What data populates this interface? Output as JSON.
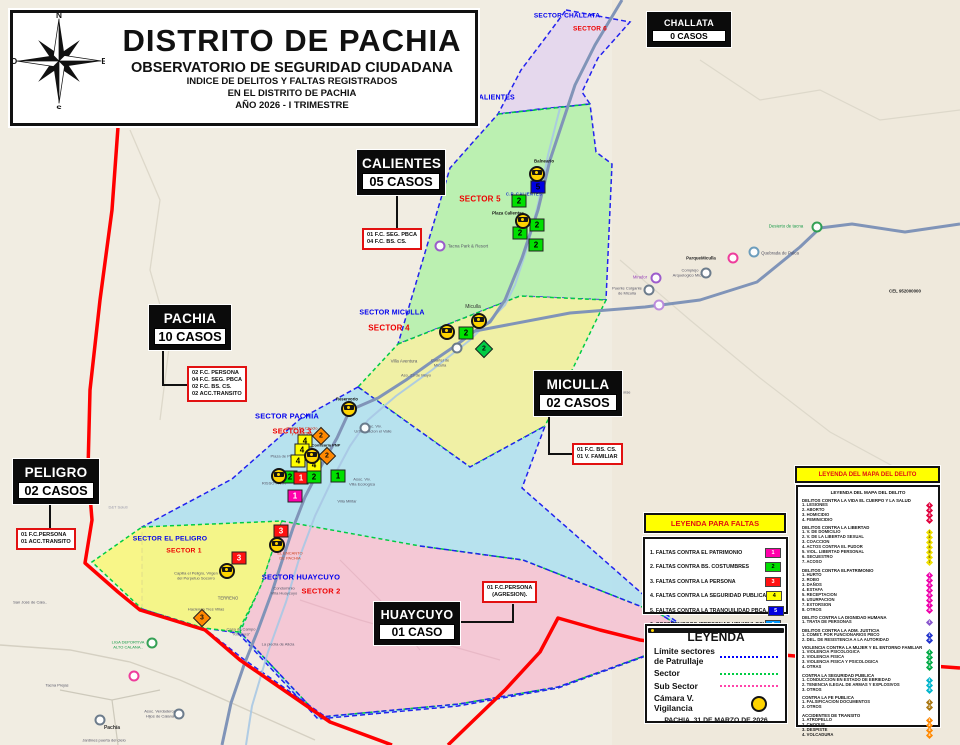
{
  "header": {
    "title": "DISTRITO DE PACHIA",
    "subtitle": "OBSERVATORIO DE SEGURIDAD CIUDADANA",
    "line1": "INDICE DE DELITOS Y FALTAS REGISTRADOS",
    "line2": "EN EL DISTRITO DE PACHIA",
    "line3": "AÑO 2026 - I TRIMESTRE",
    "compass": {
      "n": "N",
      "s": "S",
      "e": "E",
      "o": "O"
    }
  },
  "stat_boxes": [
    {
      "id": "challata",
      "name": "CHALLATA",
      "cases": "0 CASOS",
      "x": 647,
      "y": 12,
      "w": 74,
      "fs": 9
    },
    {
      "id": "calientes",
      "name": "CALIENTES",
      "cases": "05 CASOS",
      "x": 357,
      "y": 150,
      "w": 78,
      "fs": 13.5
    },
    {
      "id": "pachia",
      "name": "PACHIA",
      "cases": "10 CASOS",
      "x": 149,
      "y": 305,
      "w": 72,
      "fs": 13.5
    },
    {
      "id": "miculla",
      "name": "MICULLA",
      "cases": "02 CASOS",
      "x": 534,
      "y": 371,
      "w": 78,
      "fs": 13.5
    },
    {
      "id": "peligro",
      "name": "PELIGRO",
      "cases": "02 CASOS",
      "x": 13,
      "y": 459,
      "w": 76,
      "fs": 13.5
    },
    {
      "id": "huaycuyo",
      "name": "HUAYCUYO",
      "cases": "01 CASO",
      "x": 374,
      "y": 602,
      "w": 76,
      "fs": 12.5
    }
  ],
  "detail_boxes": [
    {
      "id": "calientes-detail",
      "x": 362,
      "y": 228,
      "center": false,
      "lines": [
        "01 F.C. SEG. PBCA",
        "04 F.C. BS. CS."
      ]
    },
    {
      "id": "pachia-detail",
      "x": 187,
      "y": 366,
      "center": false,
      "lines": [
        "02 F.C. PERSONA",
        "04 F.C. SEG. PBCA",
        "02 F.C. BS. CS.",
        "02 ACC.TRANSITO"
      ]
    },
    {
      "id": "miculla-detail",
      "x": 572,
      "y": 443,
      "center": false,
      "lines": [
        "01 F.C. BS. CS.",
        "01 V. FAMILIAR"
      ]
    },
    {
      "id": "peligro-detail",
      "x": 16,
      "y": 528,
      "center": false,
      "lines": [
        "01 F.C.PERSONA",
        "01 ACC.TRANSITO"
      ]
    },
    {
      "id": "huaycuyo-detail",
      "x": 482,
      "y": 581,
      "center": true,
      "lines": [
        "01 F.C.PERSONA",
        "(AGRESION)."
      ]
    }
  ],
  "sector_labels": [
    {
      "x": 567,
      "y": 16,
      "t": "SECTOR CHALLATA",
      "c": "#0000ee",
      "s": 6.5
    },
    {
      "x": 590,
      "y": 29,
      "t": "SECTOR 6",
      "c": "#ee0000",
      "s": 6.5
    },
    {
      "x": 478,
      "y": 98,
      "t": "SECTOR CALIENTES",
      "c": "#0000ee",
      "s": 7
    },
    {
      "x": 480,
      "y": 199,
      "t": "SECTOR 5",
      "c": "#ee0000",
      "s": 8
    },
    {
      "x": 524,
      "y": 194,
      "t": "C.P. CALIENTES",
      "c": "#2233cc",
      "s": 4.3
    },
    {
      "x": 392,
      "y": 313,
      "t": "SECTOR MICULLA",
      "c": "#0000ee",
      "s": 7
    },
    {
      "x": 389,
      "y": 328,
      "t": "SECTOR 4",
      "c": "#ee0000",
      "s": 8
    },
    {
      "x": 287,
      "y": 416,
      "t": "SECTOR PACHIA",
      "c": "#0000ee",
      "s": 7.5
    },
    {
      "x": 292,
      "y": 431,
      "t": "SECTOR 3",
      "c": "#ee0000",
      "s": 7.5
    },
    {
      "x": 170,
      "y": 539,
      "t": "SECTOR EL PELIGRO",
      "c": "#0000ee",
      "s": 6.8
    },
    {
      "x": 184,
      "y": 551,
      "t": "SECTOR 1",
      "c": "#ee0000",
      "s": 6.8
    },
    {
      "x": 301,
      "y": 577,
      "t": "SECTOR HUAYCUYO",
      "c": "#0000ee",
      "s": 7.5
    },
    {
      "x": 321,
      "y": 591,
      "t": "SECTOR 2",
      "c": "#ee0000",
      "s": 7.5
    }
  ],
  "map_labels": [
    {
      "x": 544,
      "y": 161,
      "t": "Balneario",
      "c": "#111",
      "s": 4.4,
      "b": 1
    },
    {
      "x": 508,
      "y": 213,
      "t": "Plaza Calientes",
      "c": "#111",
      "s": 4.4,
      "b": 1
    },
    {
      "x": 468,
      "y": 246,
      "t": "Tacna Park & Resort",
      "c": "#555566",
      "s": 4.4,
      "b": 0
    },
    {
      "x": 473,
      "y": 308,
      "t": "Miculla",
      "c": "#333333",
      "s": 5,
      "b": 0
    },
    {
      "x": 404,
      "y": 361,
      "t": "Villa Aventura",
      "c": "#556",
      "s": 4.4,
      "b": 0
    },
    {
      "x": 440,
      "y": 363,
      "t": "Cuartel de\nMiculla",
      "c": "#556",
      "s": 4,
      "b": 0
    },
    {
      "x": 416,
      "y": 376,
      "t": "Aso. 23 de Mayo",
      "c": "#556",
      "s": 4,
      "b": 0
    },
    {
      "x": 347,
      "y": 400,
      "t": "Reservorio",
      "c": "#111",
      "s": 4.2,
      "b": 1
    },
    {
      "x": 302,
      "y": 431,
      "t": "Pastel De Choclo\ny HUMITAS",
      "c": "#cc2200",
      "s": 4,
      "b": 0
    },
    {
      "x": 326,
      "y": 446,
      "t": "Comisaria PNP",
      "c": "#111",
      "s": 4,
      "b": 1
    },
    {
      "x": 373,
      "y": 429,
      "t": "Asoc. Viv.\nUrbanizacion el Valle",
      "c": "#556",
      "s": 4,
      "b": 0
    },
    {
      "x": 285,
      "y": 457,
      "t": "Plaza de Pachia",
      "c": "#556",
      "s": 4,
      "b": 0
    },
    {
      "x": 274,
      "y": 484,
      "t": "RISSO PARK",
      "c": "#556",
      "s": 4,
      "b": 0
    },
    {
      "x": 362,
      "y": 482,
      "t": "Asoc. Viv.\nVilla Ecologica",
      "c": "#556",
      "s": 4,
      "b": 0
    },
    {
      "x": 347,
      "y": 502,
      "t": "Villa Militar",
      "c": "#556",
      "s": 4,
      "b": 0
    },
    {
      "x": 290,
      "y": 556,
      "t": "EL ENCANTO\nDE PACHIA",
      "c": "#cc4422",
      "s": 4,
      "b": 0
    },
    {
      "x": 196,
      "y": 576,
      "t": "Capilla el Peligro, Virgen\ndel Perpetuo Socorro",
      "c": "#556",
      "s": 4,
      "b": 0
    },
    {
      "x": 228,
      "y": 599,
      "t": "TERRENO",
      "c": "#556",
      "s": 4.2,
      "b": 0
    },
    {
      "x": 206,
      "y": 610,
      "t": "Hacienda Tres Villas",
      "c": "#556",
      "s": 4,
      "b": 0
    },
    {
      "x": 284,
      "y": 591,
      "t": "Condominio\nVilla Huaycuyo",
      "c": "#556",
      "s": 4,
      "b": 0
    },
    {
      "x": 241,
      "y": 632,
      "t": "Casa de Campo\n\"Kiliseera\"",
      "c": "#556",
      "s": 4,
      "b": 0
    },
    {
      "x": 278,
      "y": 645,
      "t": "La piedra de Alicia",
      "c": "#556",
      "s": 4,
      "b": 0
    },
    {
      "x": 128,
      "y": 645,
      "t": "LIGA DEPORTIVA\nALTO CALANA..",
      "c": "#119944",
      "s": 4,
      "b": 0
    },
    {
      "x": 118,
      "y": 508,
      "t": "D&T Soluti",
      "c": "#99a",
      "s": 4,
      "b": 0
    },
    {
      "x": 30,
      "y": 603,
      "t": "San José de Cala..",
      "c": "#556",
      "s": 4,
      "b": 0
    },
    {
      "x": 57,
      "y": 686,
      "t": "Tacna Prejas",
      "c": "#556",
      "s": 4,
      "b": 0
    },
    {
      "x": 160,
      "y": 714,
      "t": "Asoc. Verdaderos\nHijos de Calana",
      "c": "#556",
      "s": 4,
      "b": 0
    },
    {
      "x": 112,
      "y": 729,
      "t": "Pachía",
      "c": "#333",
      "s": 5,
      "b": 1
    },
    {
      "x": 104,
      "y": 741,
      "t": "Jardines puerta del cielo",
      "c": "#556",
      "s": 4,
      "b": 0
    },
    {
      "x": 786,
      "y": 226,
      "t": "Desierto de tacna",
      "c": "#119944",
      "s": 4.4,
      "b": 0
    },
    {
      "x": 780,
      "y": 253,
      "t": "Quebrada de Palca",
      "c": "#556",
      "s": 4.4,
      "b": 0
    },
    {
      "x": 701,
      "y": 258,
      "t": "ParqueMiculla",
      "c": "#222",
      "s": 4.4,
      "b": 1
    },
    {
      "x": 690,
      "y": 273,
      "t": "Complejo\nArquelogico Miculla",
      "c": "#556",
      "s": 4,
      "b": 0
    },
    {
      "x": 640,
      "y": 278,
      "t": "Mirador",
      "c": "#9944bb",
      "s": 4.2,
      "b": 0
    },
    {
      "x": 627,
      "y": 291,
      "t": "Puente Colgante\nde Miculla",
      "c": "#556",
      "s": 4,
      "b": 0
    },
    {
      "x": 905,
      "y": 291,
      "t": "CEL 952000000",
      "c": "#222",
      "s": 4.4,
      "b": 1
    },
    {
      "x": 612,
      "y": 393,
      "t": "Parque Tarapacense",
      "c": "#556",
      "s": 4,
      "b": 0
    }
  ],
  "pois": [
    {
      "x": 817,
      "y": 227,
      "c": "#2a9d4e"
    },
    {
      "x": 754,
      "y": 252,
      "c": "#6699bb"
    },
    {
      "x": 733,
      "y": 258,
      "c": "#ee3399"
    },
    {
      "x": 706,
      "y": 273,
      "c": "#667788"
    },
    {
      "x": 656,
      "y": 278,
      "c": "#9955cc"
    },
    {
      "x": 649,
      "y": 290,
      "c": "#667788"
    },
    {
      "x": 659,
      "y": 305,
      "c": "#bb88dd"
    },
    {
      "x": 457,
      "y": 348,
      "c": "#667788"
    },
    {
      "x": 365,
      "y": 428,
      "c": "#667788"
    },
    {
      "x": 440,
      "y": 246,
      "c": "#9955cc"
    },
    {
      "x": 152,
      "y": 643,
      "c": "#2a9d4e"
    },
    {
      "x": 134,
      "y": 676,
      "c": "#ee3399"
    },
    {
      "x": 179,
      "y": 714,
      "c": "#667788"
    },
    {
      "x": 100,
      "y": 720,
      "c": "#667788"
    }
  ],
  "markers": [
    {
      "t": "cam",
      "x": 537,
      "y": 174
    },
    {
      "t": "sq",
      "x": 538,
      "y": 187,
      "c": "#0000e0",
      "tc": "#000",
      "n": "5"
    },
    {
      "t": "sq",
      "x": 519,
      "y": 201,
      "c": "#00e000",
      "tc": "#000",
      "n": "2"
    },
    {
      "t": "cam",
      "x": 523,
      "y": 221
    },
    {
      "t": "sq",
      "x": 537,
      "y": 225,
      "c": "#00e000",
      "tc": "#000",
      "n": "2"
    },
    {
      "t": "sq",
      "x": 520,
      "y": 233,
      "c": "#00e000",
      "tc": "#000",
      "n": "2"
    },
    {
      "t": "sq",
      "x": 536,
      "y": 245,
      "c": "#00e000",
      "tc": "#000",
      "n": "2"
    },
    {
      "t": "cam",
      "x": 479,
      "y": 321
    },
    {
      "t": "cam",
      "x": 447,
      "y": 332
    },
    {
      "t": "sq",
      "x": 466,
      "y": 333,
      "c": "#00e000",
      "tc": "#000",
      "n": "2"
    },
    {
      "t": "dm",
      "x": 484,
      "y": 349,
      "c": "#00cc44",
      "n": "2"
    },
    {
      "t": "cam",
      "x": 349,
      "y": 409
    },
    {
      "t": "dm",
      "x": 321,
      "y": 436,
      "c": "#ff8800",
      "n": "2"
    },
    {
      "t": "sq",
      "x": 305,
      "y": 441,
      "c": "#ffff00",
      "tc": "#000",
      "n": "4"
    },
    {
      "t": "sq",
      "x": 302,
      "y": 450,
      "c": "#ffff00",
      "tc": "#000",
      "n": "4"
    },
    {
      "t": "cam",
      "x": 312,
      "y": 456
    },
    {
      "t": "dm",
      "x": 327,
      "y": 456,
      "c": "#ff8800",
      "n": "2"
    },
    {
      "t": "sq",
      "x": 298,
      "y": 461,
      "c": "#ffff00",
      "tc": "#000",
      "n": "4"
    },
    {
      "t": "sq",
      "x": 314,
      "y": 465,
      "c": "#ffff00",
      "tc": "#000",
      "n": "4"
    },
    {
      "t": "cam",
      "x": 279,
      "y": 476
    },
    {
      "t": "sq",
      "x": 290,
      "y": 477,
      "c": "#00e000",
      "tc": "#000",
      "n": "2"
    },
    {
      "t": "sq",
      "x": 301,
      "y": 478,
      "c": "#ff1111",
      "tc": "#fff",
      "n": "1"
    },
    {
      "t": "sq",
      "x": 314,
      "y": 477,
      "c": "#00e000",
      "tc": "#000",
      "n": "2"
    },
    {
      "t": "sq",
      "x": 338,
      "y": 476,
      "c": "#00e000",
      "tc": "#000",
      "n": "1"
    },
    {
      "t": "sq",
      "x": 295,
      "y": 496,
      "c": "#ff00aa",
      "tc": "#fff",
      "n": "1"
    },
    {
      "t": "sq",
      "x": 281,
      "y": 531,
      "c": "#ff1111",
      "tc": "#fff",
      "n": "3"
    },
    {
      "t": "cam",
      "x": 277,
      "y": 545
    },
    {
      "t": "sq",
      "x": 239,
      "y": 558,
      "c": "#ff1111",
      "tc": "#fff",
      "n": "3"
    },
    {
      "t": "cam",
      "x": 227,
      "y": 571
    },
    {
      "t": "dm",
      "x": 202,
      "y": 618,
      "c": "#ff8800",
      "n": "3"
    }
  ],
  "legend_faltas": {
    "title": "LEYENDA PARA FALTAS",
    "items": [
      {
        "label": "1. FALTAS CONTRA EL PATRIMONIO",
        "color": "#ff00aa",
        "num": "1"
      },
      {
        "label": "2. FALTAS CONTRA BS. COSTUMBRES",
        "color": "#00dd00",
        "num": "2"
      },
      {
        "label": "3. FALTAS CONTRA LA PERSONA",
        "color": "#ff1111",
        "num": "3"
      },
      {
        "label": "4. FALTAS CONTRA LA SEGURIDAD PUBLICA",
        "color": "#ffff00",
        "num": "4"
      },
      {
        "label": "5. FALTAS CONTRA LA TRANQUILIDAD PBCA.",
        "color": "#0000dd",
        "num": "5"
      },
      {
        "label": "6. SOSPECHOSOS (PERSONAS-VEHICULOS)",
        "color": "#0099ff",
        "num": "6"
      }
    ]
  },
  "legend_main": {
    "title": "LEYENDA",
    "items": [
      {
        "label": "Límite sectores de Patrullaje",
        "swatch": "dotted-blue"
      },
      {
        "label": "Sector",
        "swatch": "dotted-green"
      },
      {
        "label": "Sub Sector",
        "swatch": "dotted-pink"
      },
      {
        "label": "Cámara V. Vigilancia",
        "swatch": "camera"
      }
    ],
    "footer": "PACHIA, 31 DE MARZO DE 2026"
  },
  "legend_delito": {
    "title": "LEYENDA DEL MAPA DEL DELITO",
    "inner_title": "LEYENDA DEL MAPA DEL DELITO",
    "sections": [
      {
        "header": "DELITOS CONTRA LA VIDA EL CUERPO Y LA SALUD",
        "color": "#e0003c",
        "items": [
          "1. LESIONES",
          "2. ABORTO",
          "3. HOMICIDIO",
          "4. FEMINICIDIO"
        ]
      },
      {
        "header": "DELITOS CONTRA LA LIBERTAD",
        "color": "#f0e000",
        "items": [
          "1. V. DE DOMICILIO",
          "2. V. DE LA LIBERTAD SEXUAL",
          "3. COACCION",
          "4. ACTOS CONTRA EL PUDOR",
          "5. VIOL. LIBERTAD PERSONAL",
          "6. SECUESTRO",
          "7. ACOSO"
        ]
      },
      {
        "header": "DELITOS CONTRA ELPATRIMONIO",
        "color": "#ee00aa",
        "items": [
          "1. HURTO",
          "2. ROBO",
          "3. DAÑOS",
          "4. ESTAFA",
          "5. RECEPTACION",
          "6. USURPACION",
          "7. EXTORSION",
          "8. OTROS"
        ]
      },
      {
        "header": "DELITO CONTRA LA DIGNIDAD HUMANA",
        "color": "#8855cc",
        "items": [
          "1. TRATA DE PERSONAS"
        ]
      },
      {
        "header": "DELITOS CONTRA LA ADM. JUSTICIA",
        "color": "#2233cc",
        "items": [
          "1. COMET. POR FUNCIONARIOS PBCO",
          "2. DEL. DE RESISTENCIA A LA AUTORIDAD"
        ]
      },
      {
        "header": "VIOLENCIA CONTRA LA MUJER Y EL ENTORNO FAMILIAR",
        "color": "#00aa44",
        "items": [
          "1. VIOLENCIA PSICOLOGICA",
          "2. VIOLENCIA FISICA",
          "3. VIOLENCIA FISICA Y PSICOLOGICA",
          "4. OTRAS"
        ]
      },
      {
        "header": "CONTRA LA SEGURIDAD PUBLICA",
        "color": "#00b4cc",
        "items": [
          "1. CONDUCCION EN ESTADO DE EBRIEDAD",
          "2. TENENCIA ILEGAL DE ARMAS Y EXPLOSIVOS",
          "3. OTROS"
        ]
      },
      {
        "header": "CONTRA LA FE PUBLICA",
        "color": "#aa7711",
        "items": [
          "1. FALSIFICACION DOCUMENTOS",
          "2. OTROS"
        ]
      },
      {
        "header": "ACCIDENTES DE TRANSITO",
        "color": "#ff8800",
        "items": [
          "1. ATROPELLO",
          "2. CHOQUE",
          "3. DESPISTE",
          "4. VOLCADURA"
        ]
      }
    ]
  }
}
